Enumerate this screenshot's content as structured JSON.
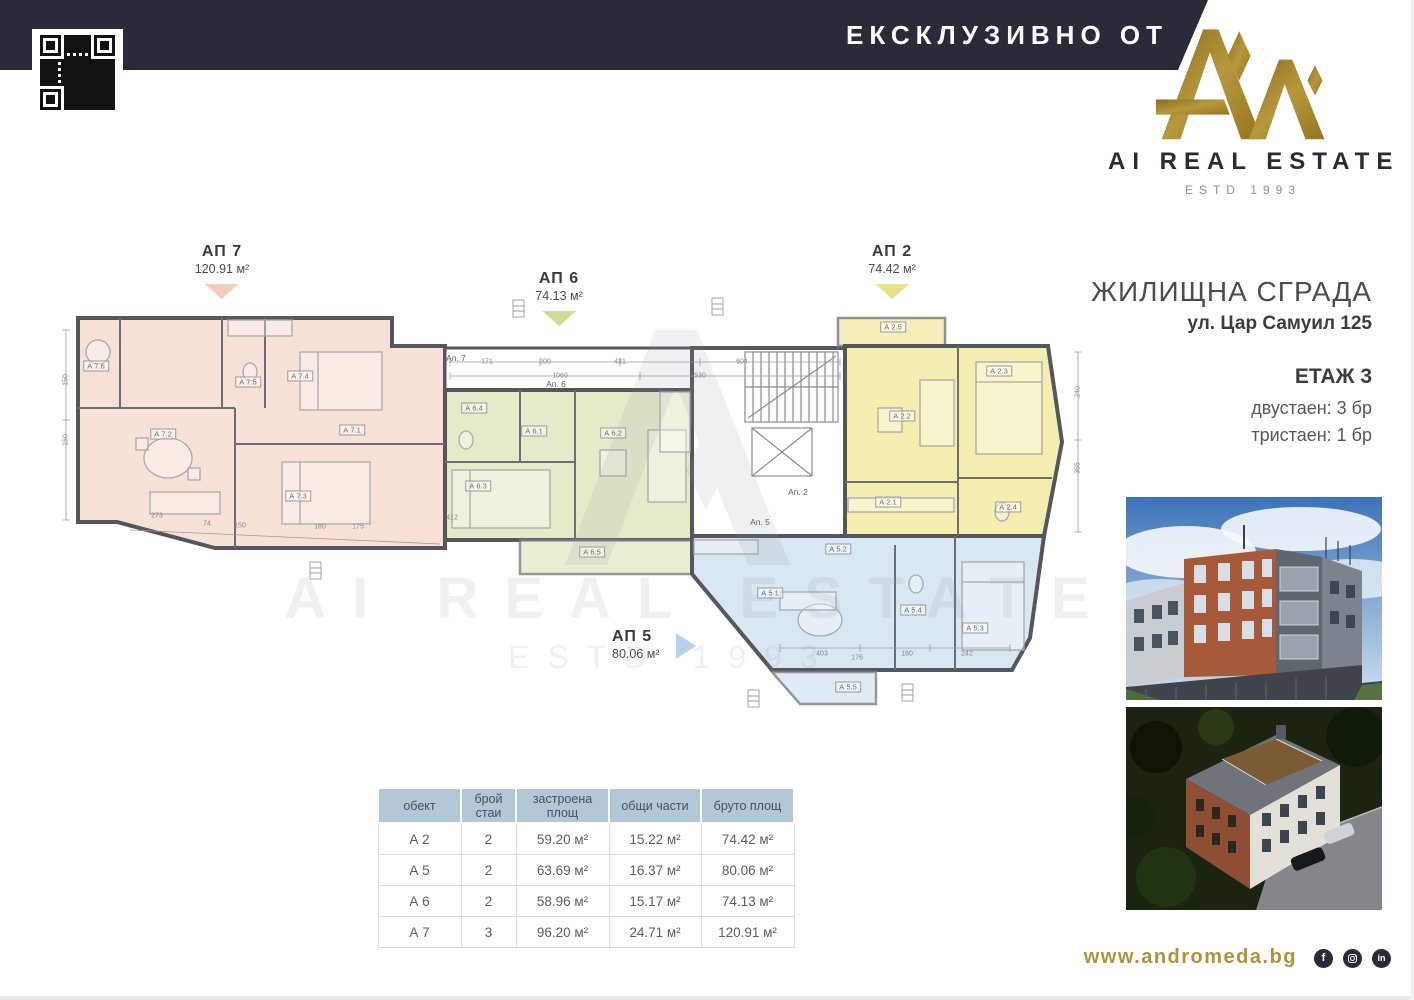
{
  "banner": {
    "exclusive_label": "ЕКСКЛУЗИВНО ОТ"
  },
  "brand": {
    "name": "AI REAL ESTATE",
    "estd": "ESTD 1993"
  },
  "project": {
    "title": "ЖИЛИЩНА СГРАДА",
    "address": "ул. Цар Самуил 125",
    "floor": "ЕТАЖ 3",
    "unit_mix": [
      "двустаен: 3 бр",
      "тристаен: 1 бр"
    ]
  },
  "plan": {
    "colors": {
      "ap7": "#f8e2d7",
      "ap6": "#e3ecc9",
      "ap2": "#f4eeb0",
      "ap5": "#d9e7f2",
      "wall": "#55565e"
    },
    "callouts": [
      {
        "label": "АП 7",
        "area": "120.91 м²",
        "x": 222,
        "y": 243,
        "pointer": "down",
        "color": "#f3cdba"
      },
      {
        "label": "АП 6",
        "area": "74.13 м²",
        "x": 559,
        "y": 270,
        "pointer": "down",
        "color": "#cfdb9a"
      },
      {
        "label": "АП 2",
        "area": "74.42 м²",
        "x": 892,
        "y": 243,
        "pointer": "down",
        "color": "#e9e18a"
      },
      {
        "label": "АП 5",
        "area": "80.06 м²",
        "x": 612,
        "y": 628,
        "pointer": "right",
        "color": "#b6d3ec"
      }
    ],
    "core_labels": [
      {
        "t": "Ап. 7",
        "x": 456,
        "y": 358
      },
      {
        "t": "Ап. 6",
        "x": 556,
        "y": 384
      },
      {
        "t": "Ап. 2",
        "x": 798,
        "y": 492
      },
      {
        "t": "Ап. 5",
        "x": 760,
        "y": 522
      }
    ],
    "room_labels": [
      {
        "t": "А 7.6",
        "x": 96,
        "y": 366
      },
      {
        "t": "А 7.5",
        "x": 248,
        "y": 382
      },
      {
        "t": "А 7.4",
        "x": 300,
        "y": 376
      },
      {
        "t": "А 7.1",
        "x": 352,
        "y": 430
      },
      {
        "t": "А 7.2",
        "x": 163,
        "y": 434
      },
      {
        "t": "А 7.3",
        "x": 298,
        "y": 496
      },
      {
        "t": "А 6.4",
        "x": 474,
        "y": 408
      },
      {
        "t": "А 6.1",
        "x": 534,
        "y": 431
      },
      {
        "t": "А 6.2",
        "x": 613,
        "y": 433
      },
      {
        "t": "А 6.3",
        "x": 478,
        "y": 486
      },
      {
        "t": "А 6.5",
        "x": 592,
        "y": 552
      },
      {
        "t": "А 2.5",
        "x": 893,
        "y": 327
      },
      {
        "t": "А 2.2",
        "x": 902,
        "y": 416
      },
      {
        "t": "А 2.3",
        "x": 999,
        "y": 371
      },
      {
        "t": "А 2.1",
        "x": 888,
        "y": 502
      },
      {
        "t": "А 2.4",
        "x": 1008,
        "y": 507
      },
      {
        "t": "А 5.1",
        "x": 770,
        "y": 593
      },
      {
        "t": "А 5.2",
        "x": 838,
        "y": 549
      },
      {
        "t": "А 5.4",
        "x": 913,
        "y": 610
      },
      {
        "t": "А 5.3",
        "x": 975,
        "y": 628
      },
      {
        "t": "А 5.5",
        "x": 848,
        "y": 687
      }
    ],
    "dim_labels": [
      {
        "t": "171",
        "x": 487,
        "y": 362
      },
      {
        "t": "200",
        "x": 545,
        "y": 362
      },
      {
        "t": "431",
        "x": 620,
        "y": 362
      },
      {
        "t": "604",
        "x": 742,
        "y": 362
      },
      {
        "t": "1060",
        "x": 560,
        "y": 376
      },
      {
        "t": "530",
        "x": 700,
        "y": 376
      },
      {
        "t": "273",
        "x": 157,
        "y": 516
      },
      {
        "t": "74",
        "x": 207,
        "y": 524
      },
      {
        "t": "150",
        "x": 240,
        "y": 526
      },
      {
        "t": "180",
        "x": 320,
        "y": 527
      },
      {
        "t": "175",
        "x": 358,
        "y": 527
      },
      {
        "t": "412",
        "x": 452,
        "y": 518
      },
      {
        "t": "403",
        "x": 822,
        "y": 654
      },
      {
        "t": "176",
        "x": 857,
        "y": 658
      },
      {
        "t": "180",
        "x": 907,
        "y": 654
      },
      {
        "t": "242",
        "x": 967,
        "y": 654
      },
      {
        "t": "150",
        "x": 66,
        "y": 380,
        "rot": true
      },
      {
        "t": "150",
        "x": 66,
        "y": 440,
        "rot": true
      },
      {
        "t": "240",
        "x": 1078,
        "y": 392,
        "rot": true
      },
      {
        "t": "355",
        "x": 1078,
        "y": 468,
        "rot": true
      }
    ],
    "watermark": {
      "line1": "AI REAL ESTATE",
      "line2": "ESTD 1993"
    }
  },
  "table": {
    "headers": [
      "обект",
      "брой стаи",
      "застроена площ",
      "общи части",
      "бруто площ"
    ],
    "col_widths": [
      83,
      55,
      93,
      92,
      93
    ],
    "rows": [
      [
        "А 2",
        "2",
        "59.20 м²",
        "15.22 м²",
        "74.42 м²"
      ],
      [
        "А 5",
        "2",
        "63.69 м²",
        "16.37 м²",
        "80.06 м²"
      ],
      [
        "А 6",
        "2",
        "58.96 м²",
        "15.17 м²",
        "74.13 м²"
      ],
      [
        "А 7",
        "3",
        "96.20 м²",
        "24.71 м²",
        "120.91 м²"
      ]
    ]
  },
  "footer": {
    "website": "www.andromeda.bg",
    "social": [
      {
        "name": "facebook",
        "glyph": "f"
      },
      {
        "name": "instagram",
        "glyph": ""
      },
      {
        "name": "linkedin",
        "glyph": "in"
      }
    ]
  }
}
